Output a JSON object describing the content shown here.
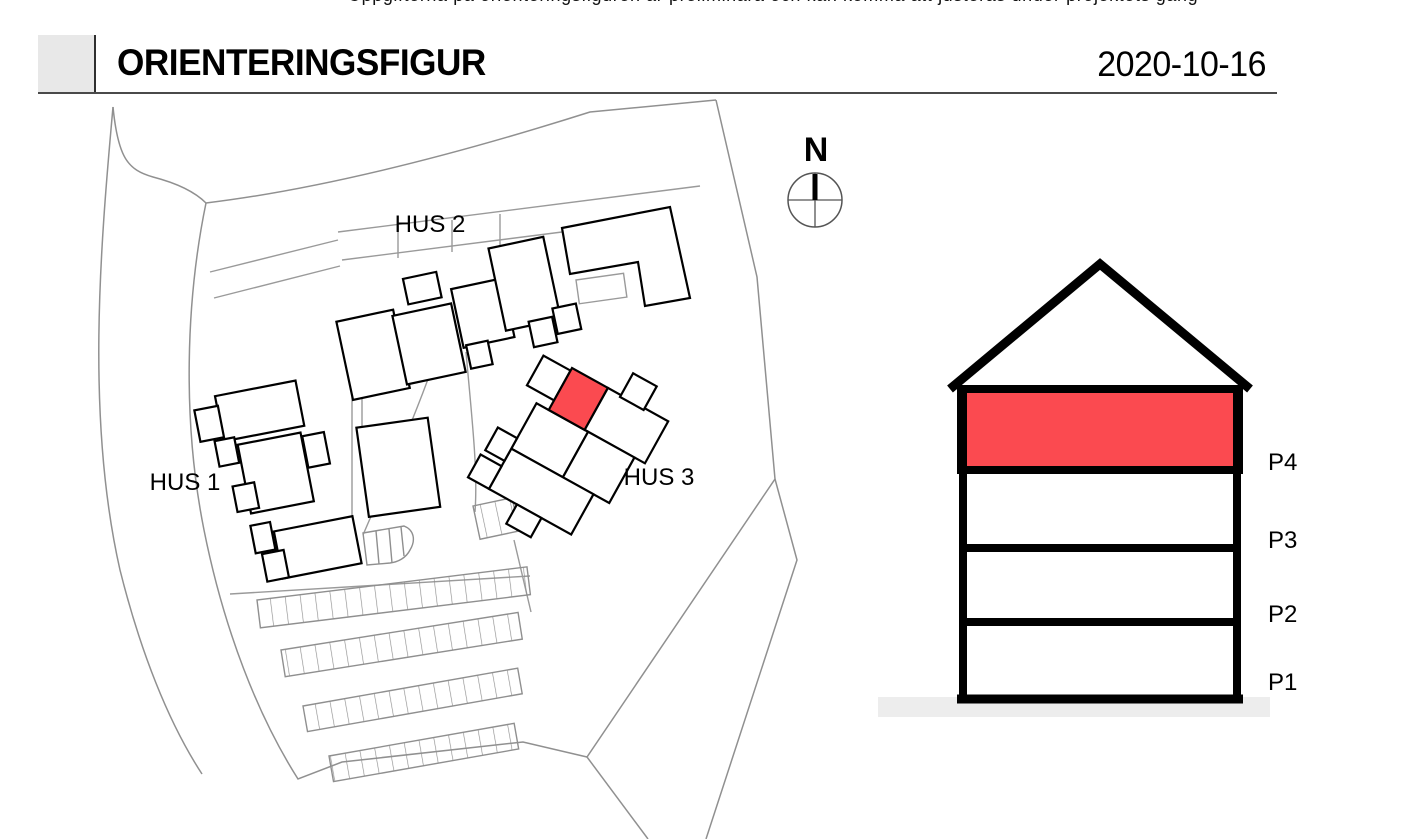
{
  "page": {
    "top_note_partial": "Uppgifterna på orienteringsfiguren är preliminära och kan komma att justeras under projektets gång"
  },
  "header": {
    "title": "ORIENTERINGSFIGUR",
    "date": "2020-10-16"
  },
  "site_plan": {
    "building_labels": [
      {
        "id": "hus2",
        "label": "HUS 2"
      },
      {
        "id": "hus1",
        "label": "HUS 1"
      },
      {
        "id": "hus3",
        "label": "HUS 3"
      }
    ],
    "compass": {
      "label": "N"
    },
    "highlight_color": "#fb4a50",
    "highlighted_building": "HUS 3"
  },
  "elevation": {
    "floors": [
      {
        "label": "P4",
        "highlighted": true
      },
      {
        "label": "P3",
        "highlighted": false
      },
      {
        "label": "P2",
        "highlighted": false
      },
      {
        "label": "P1",
        "highlighted": false
      }
    ],
    "highlighted_floor": "P4",
    "ground_color": "#ededed"
  }
}
